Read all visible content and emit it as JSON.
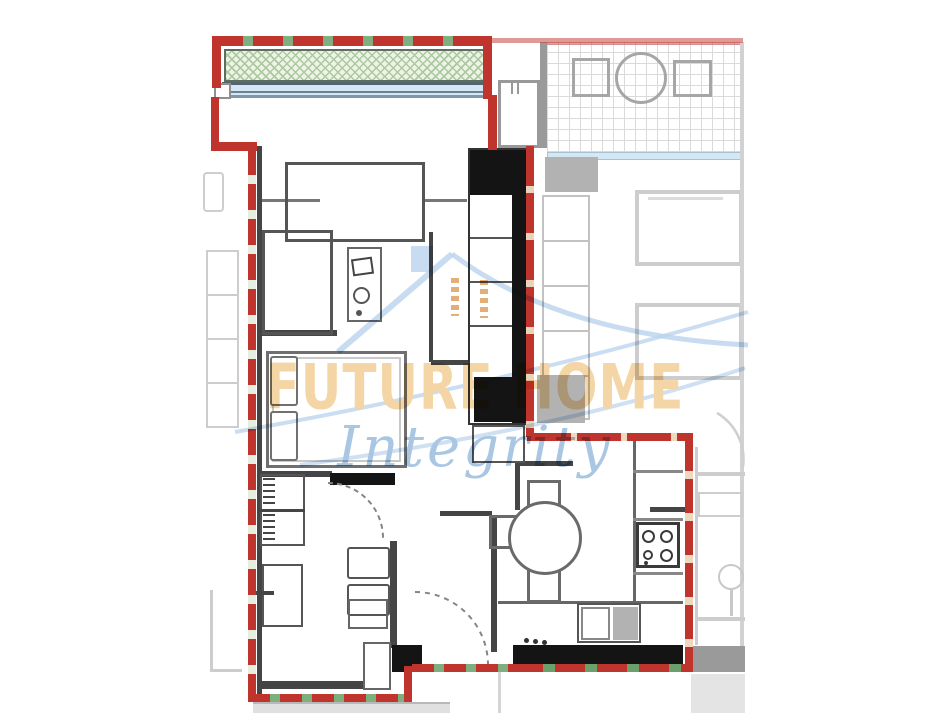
{
  "watermark": {
    "brand": "FUTURE HOME",
    "tagline": "Integrity",
    "house_icon": "house-roof-swoosh-icon"
  },
  "floorplan": {
    "type": "apartment-floor-plan",
    "features": [
      "balcony",
      "living-room",
      "bedroom",
      "bathroom",
      "kitchen-dining",
      "entrance"
    ],
    "boundary_style": "red-green-dashed"
  },
  "colors": {
    "boundary_red": "#c0342e",
    "dash_green": "#7fae7f",
    "dash_pale": "#e6eee2",
    "wall_dark": "#454545",
    "wall_black": "#141414",
    "furn_gray": "#6a6a6a",
    "furn_light": "#9a9a9a",
    "balcony_fill": "#eef4e5",
    "balcony_hatch": "#abc8a1",
    "hatch_border": "#5c6e60",
    "window_blue": "#d3e7f4",
    "window_edge": "#55656f",
    "neighbor_line": "#cdcdcd",
    "neighbor_mid": "#a6a6a6",
    "neighbor_fill": "#b2b2b2",
    "neighbor_fill_dark": "#9a9a9a",
    "grid_line": "#dadada",
    "brand_peach": "#f4d5a6",
    "script_blue": "#a9c6e2",
    "house_blue": "#b9d3ec",
    "dots_orange": "#e2a05f"
  }
}
